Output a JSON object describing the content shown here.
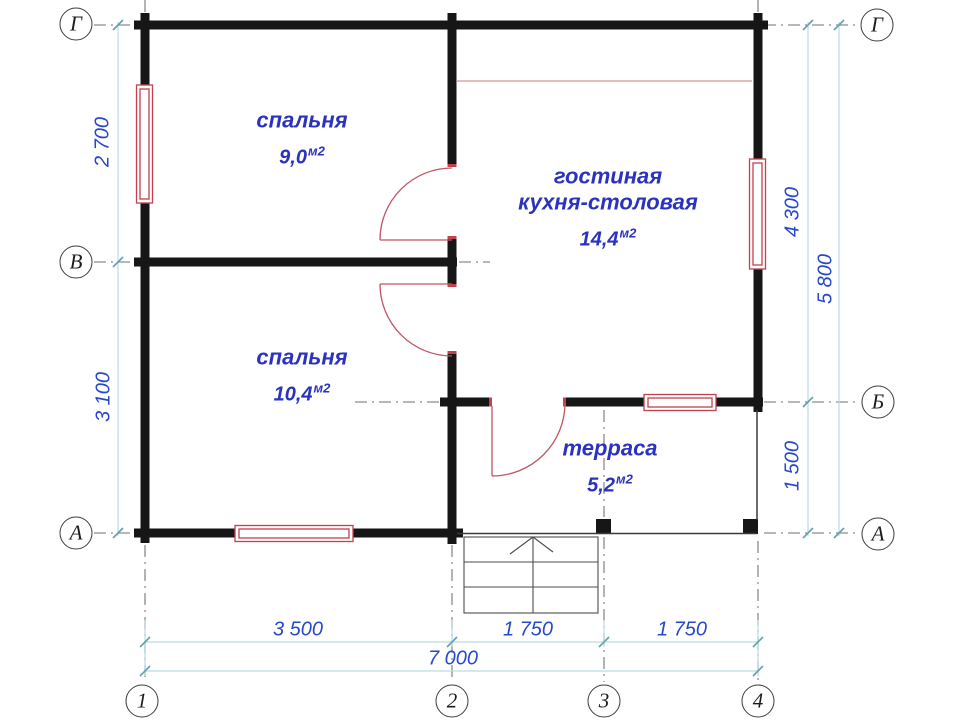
{
  "title": "План дома 7000×5800",
  "rooms": [
    {
      "name": "спальня",
      "area": "9,0",
      "unit": "м2"
    },
    {
      "name": "гостиная",
      "name2": "кухня-столовая",
      "area": "14,4",
      "unit": "м2"
    },
    {
      "name": "спальня",
      "area": "10,4",
      "unit": "м2"
    },
    {
      "name": "терраса",
      "area": "5,2",
      "unit": "м2"
    }
  ],
  "dims": {
    "left_top": "2 700",
    "left_bottom": "3 100",
    "right_top": "4 300",
    "right_total": "5 800",
    "right_bottom": "1 500",
    "bottom_a": "3 500",
    "bottom_b": "1 750",
    "bottom_c": "1 750",
    "bottom_total": "7 000"
  },
  "markers": {
    "g_left": "Г",
    "g_right": "Г",
    "v_left": "В",
    "b_right": "Б",
    "a_left": "А",
    "a_right": "А",
    "col_1": "1",
    "col_2": "2",
    "col_3": "3",
    "col_4": "4"
  },
  "colors": {
    "wall": "#161616",
    "opening_red": "#c4404d",
    "dimension_line": "#b9dde2",
    "dimension_tick": "#64a0ab",
    "dimension_text": "#2748cb",
    "room_text": "#2a32be",
    "axis_dash": "#8c8c8c"
  },
  "icons": {
    "stairs_direction_arrow": "chevron-up"
  }
}
